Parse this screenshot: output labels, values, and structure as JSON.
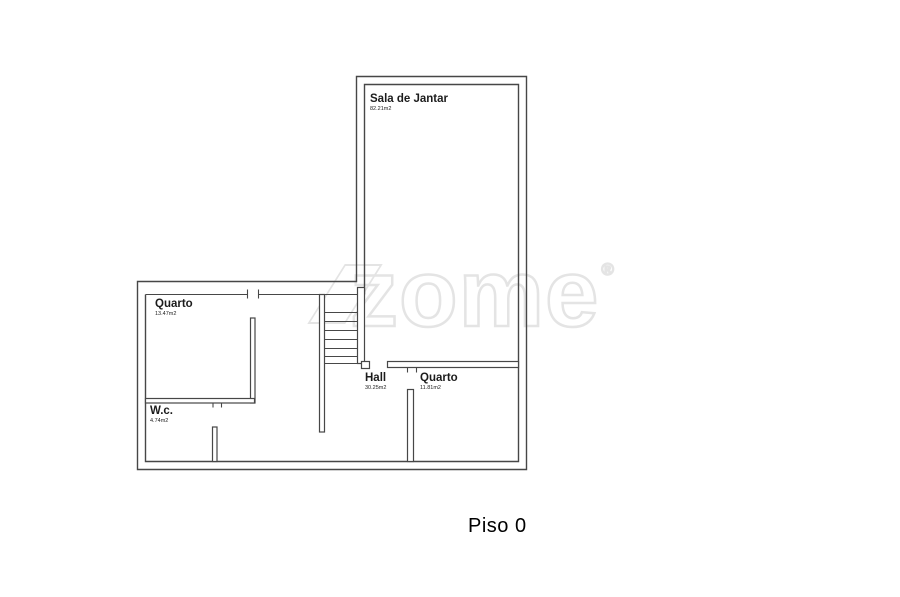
{
  "floor": {
    "title": "Piso 0"
  },
  "watermark": {
    "text": "zome",
    "registered": "®"
  },
  "rooms": [
    {
      "id": "sala-de-jantar",
      "name": "Sala de Jantar",
      "area": "82.21m2"
    },
    {
      "id": "quarto-left",
      "name": "Quarto",
      "area": "13.47m2"
    },
    {
      "id": "wc",
      "name": "W.c.",
      "area": "4.74m2"
    },
    {
      "id": "hall",
      "name": "Hall",
      "area": "30.25m2"
    },
    {
      "id": "quarto-right",
      "name": "Quarto",
      "area": "11.81m2"
    }
  ],
  "colors": {
    "wall": "#474747",
    "label_text": "#1c1c1c",
    "watermark": "#e4e4e4",
    "background": "#ffffff"
  }
}
